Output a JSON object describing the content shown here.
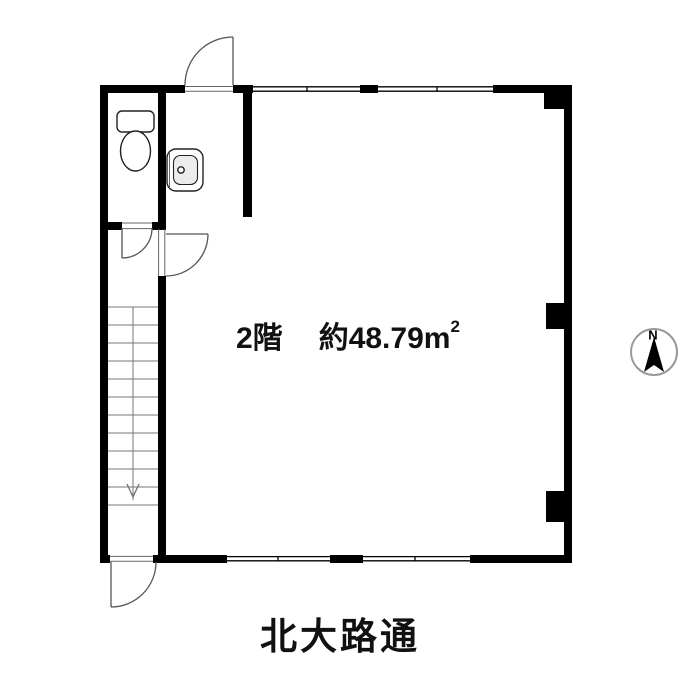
{
  "room": {
    "floor_label": "2階",
    "area_prefix": "約",
    "area_value": "48.79",
    "area_unit": "m",
    "area_unit_sup": "2"
  },
  "street": {
    "name": "北大路通"
  },
  "compass": {
    "north_label": "N"
  },
  "icons": {
    "compass-needle-icon": "black triangle pointing north",
    "toilet-icon": "plan-view toilet symbol",
    "sink-icon": "plan-view wash basin symbol",
    "stairs-down-arrow-icon": "v arrowhead"
  },
  "colors": {
    "background": "#ffffff",
    "wall": "#000000",
    "thin_line": "#666666",
    "door_arc": "#555555",
    "stair_line": "#777777",
    "fixture_stroke": "#222222",
    "fixture_fill": "#ececec",
    "compass_ring": "#999999",
    "compass_needle": "#000000"
  }
}
